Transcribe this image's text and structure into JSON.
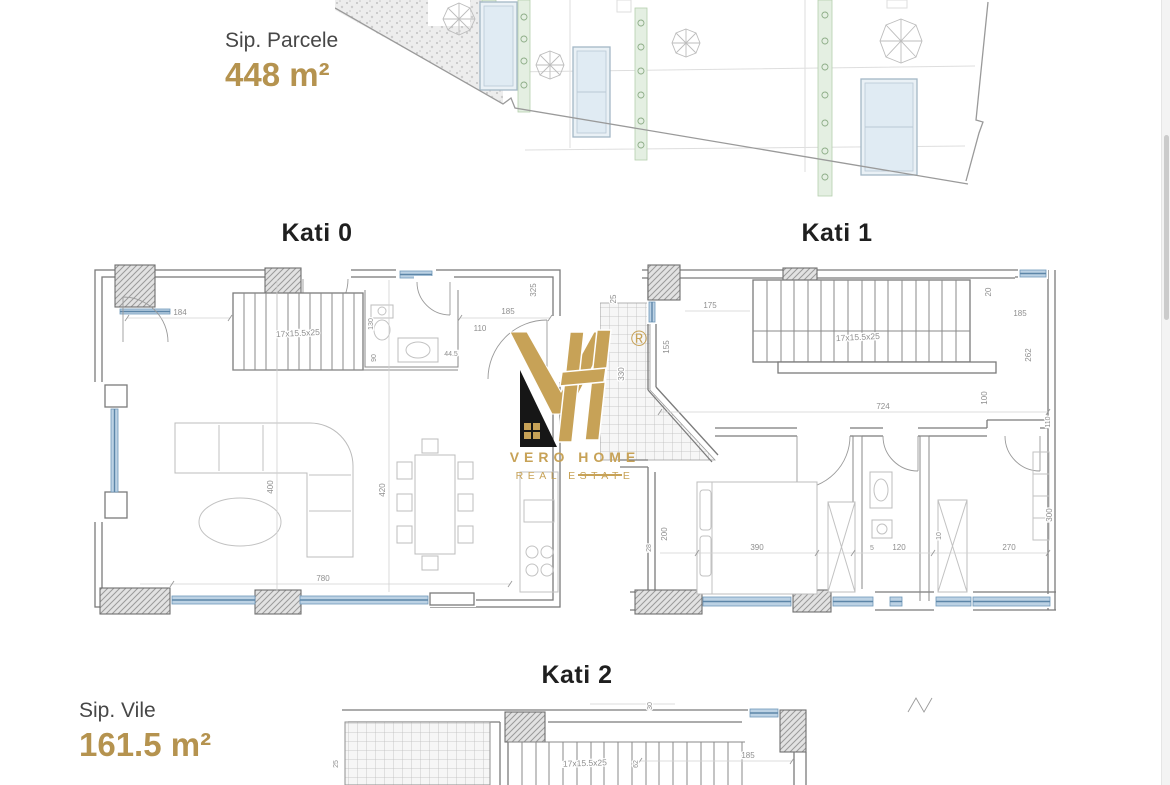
{
  "areas": {
    "parcel_label": "Sip. Parcele",
    "parcel_value": "448 m²",
    "villa_label": "Sip. Vile",
    "villa_value": "161.5 m²"
  },
  "floors": {
    "kati0": {
      "title": "Kati 0",
      "stair_label": "17x15.5x25",
      "dims": {
        "hall_width": "184",
        "bath_side": "130",
        "wc_side": "90",
        "bath_width": "110",
        "bath_door": "44.5",
        "closet_width": "185",
        "right_side": "325",
        "living_width": "400",
        "dining_width": "420",
        "total_width": "780"
      }
    },
    "kati1": {
      "title": "Kati 1",
      "stair_label": "17x15.5x25",
      "dims": {
        "left_top": "25",
        "landing_width": "175",
        "window_height": "155",
        "terrace_side": "330",
        "top_right": "20",
        "right_width": "185",
        "right_side": "262",
        "corridor": "100",
        "total_width": "724",
        "bed_width": "390",
        "bed_side": "200",
        "wall_thk": "28",
        "gap": "5",
        "bath_width": "120",
        "wardrobe": "10",
        "room_width": "270",
        "room_side": "300",
        "edge": "110"
      }
    },
    "kati2": {
      "title": "Kati 2",
      "stair_label": "17x15.5x25",
      "dims": {
        "right_width": "185",
        "top_small": "30",
        "stair_side": "62",
        "left_side": "25"
      }
    }
  },
  "logo": {
    "registered": "®",
    "brand": "VERO HOME",
    "tagline": "REAL ESTATE"
  },
  "colors": {
    "gold_text": "#b5934f",
    "logo_gold": "#c7a257",
    "heading": "#1f1f1f",
    "window_blue": "#bcd2e4"
  }
}
